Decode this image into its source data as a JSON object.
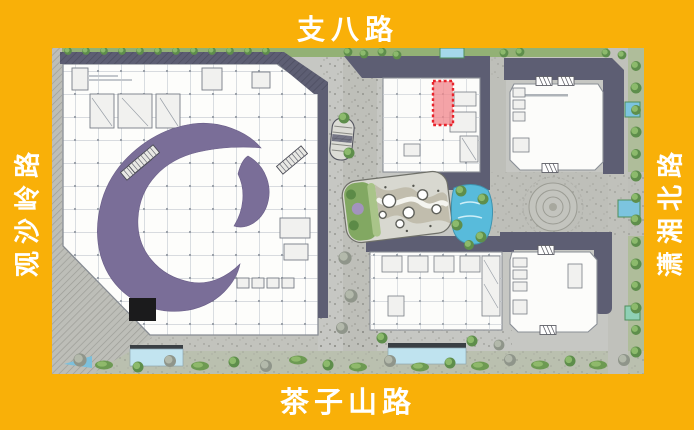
{
  "poster": {
    "background_color": "#F9B008",
    "label_color": "#FFFFFF"
  },
  "road_labels": {
    "top": "支八路",
    "bottom": "茶子山路",
    "left": "观沙岭路",
    "right": "潇湘北路"
  },
  "site_plan": {
    "type": "architectural-site-plan",
    "highlighted_unit": {
      "shape": "red dashed rectangle",
      "fill": "#F2868B",
      "border": "#E8232B"
    },
    "colors": {
      "atrium_purple": "#7A6E98",
      "roof_shadow": "#5D5E73",
      "water": "#58BBDB",
      "landscape_green": "#7FA55E",
      "pavement": "#C6C7C3"
    }
  }
}
